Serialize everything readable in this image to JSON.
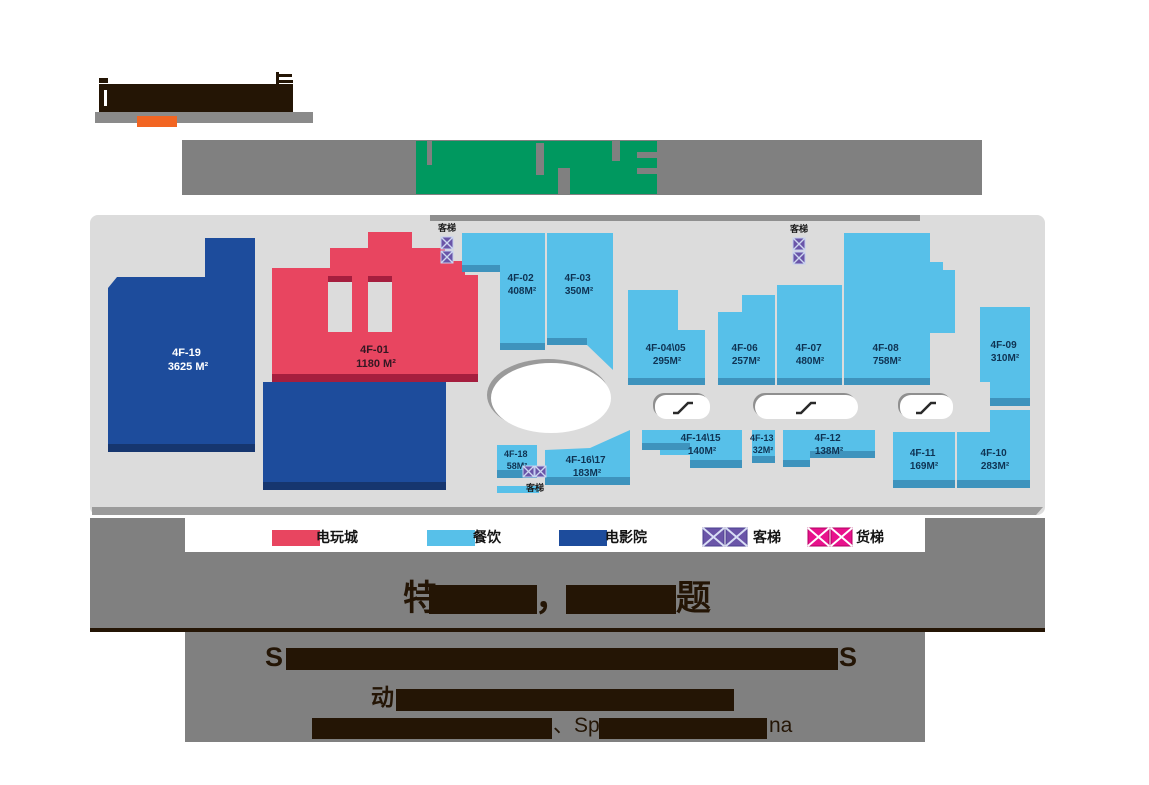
{
  "logo": {
    "bar_color": "#8a8a8a",
    "underline_color": "#f26522",
    "redaction_color": "#241505"
  },
  "title": {
    "band_color": "#808080",
    "redaction_green": "#00985f"
  },
  "plan": {
    "panel_bg": "#dcdcdc",
    "panel_edge": "#8f8f8f",
    "elevator_label": "客梯",
    "categories": {
      "arcade": {
        "fill": "#e84560",
        "edge": "#a51e3e",
        "text": "#331722"
      },
      "dining": {
        "fill": "#57c0e9",
        "edge": "#3e93bd",
        "text": "#0f3353"
      },
      "cinema": {
        "fill": "#1d4c9c",
        "edge": "#16366f",
        "text": "#ffffff"
      }
    },
    "units": [
      {
        "id": "4F-19",
        "area": "3625 M²",
        "category": "cinema"
      },
      {
        "id": "4F-01",
        "area": "1180 M²",
        "category": "arcade"
      },
      {
        "id": "4F-02",
        "area": "408M²",
        "category": "dining"
      },
      {
        "id": "4F-03",
        "area": "350M²",
        "category": "dining"
      },
      {
        "id": "4F-04\\05",
        "area": "295M²",
        "category": "dining"
      },
      {
        "id": "4F-06",
        "area": "257M²",
        "category": "dining"
      },
      {
        "id": "4F-07",
        "area": "480M²",
        "category": "dining"
      },
      {
        "id": "4F-08",
        "area": "758M²",
        "category": "dining"
      },
      {
        "id": "4F-09",
        "area": "310M²",
        "category": "dining"
      },
      {
        "id": "4F-10",
        "area": "283M²",
        "category": "dining"
      },
      {
        "id": "4F-11",
        "area": "169M²",
        "category": "dining"
      },
      {
        "id": "4F-12",
        "area": "138M²",
        "category": "dining"
      },
      {
        "id": "4F-13",
        "area": "32M²",
        "category": "dining"
      },
      {
        "id": "4F-14\\15",
        "area": "140M²",
        "category": "dining"
      },
      {
        "id": "4F-16\\17",
        "area": "183M²",
        "category": "dining"
      },
      {
        "id": "4F-18",
        "area": "58M²",
        "category": "dining"
      }
    ]
  },
  "legend": {
    "items": [
      {
        "label": "电玩城",
        "type": "swatch",
        "color": "#e84560"
      },
      {
        "label": "餐饮",
        "type": "swatch",
        "color": "#57c0e9"
      },
      {
        "label": "电影院",
        "type": "swatch",
        "color": "#1d4c9c"
      },
      {
        "label": "客梯",
        "type": "elevator",
        "color": "#6a55a8"
      },
      {
        "label": "货梯",
        "type": "elevator",
        "color": "#e8128c"
      }
    ]
  },
  "footer": {
    "band_color": "#808080",
    "ink": "#241505",
    "slogan": {
      "f1": "特",
      "comma": "，",
      "f2": "题"
    },
    "english": {
      "start": "S",
      "end": "S"
    },
    "line3": {
      "f1": "动"
    },
    "line4": {
      "f1": "、Sp",
      "f2": "na"
    }
  }
}
